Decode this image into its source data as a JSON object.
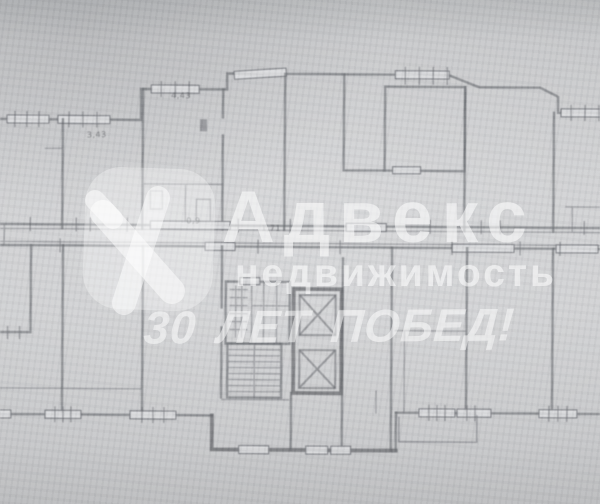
{
  "watermark": {
    "logo_icon": "advex-logo",
    "brand": "Адвекс",
    "subtitle": "недвижимость",
    "slogan": "30 ЛЕТ ПОБЕД!",
    "color": "#ffffff"
  },
  "plan": {
    "ink_color": "#5e6066",
    "paper_color": "#cbccce",
    "dimension_labels": [
      {
        "text": "3,43"
      },
      {
        "text": "4,43"
      },
      {
        "text": "0,9"
      },
      {
        "text": "1,71"
      }
    ],
    "features": [
      "staircase",
      "elevator-shaft",
      "ventilation-shaft",
      "entrance-vestibule",
      "balcony",
      "window-openings",
      "corridor-walls",
      "apartment-walls"
    ]
  }
}
